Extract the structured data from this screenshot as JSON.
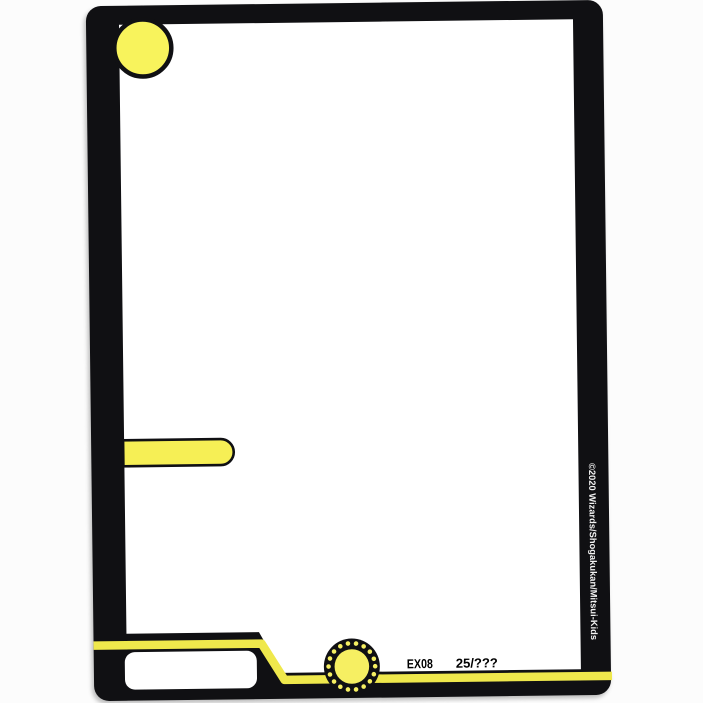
{
  "card": {
    "set_code": "EX08",
    "collector_number": "25/???",
    "copyright": "©2020 Wizards/Shogakukan/Mitsui-Kids",
    "name_box_text": "",
    "colors": {
      "frame_black": "#101013",
      "accent_yellow": "#efe84c",
      "cost_circle_yellow": "#f8f35c",
      "race_bar_yellow": "#f6ef55",
      "power_circle_yellow": "#f6ef62",
      "card_white": "#ffffff",
      "copyright_white": "#f2f2f2"
    }
  }
}
